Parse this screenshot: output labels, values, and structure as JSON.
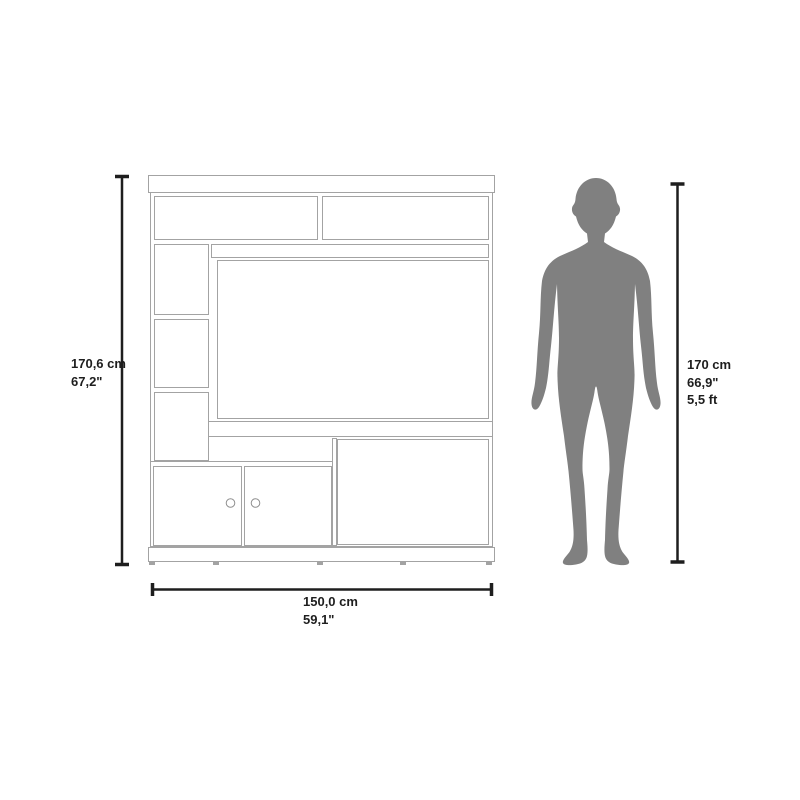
{
  "colors": {
    "background": "#ffffff",
    "furniture_outline": "#a3a3a3",
    "dimension_line": "#1e1e1e",
    "silhouette": "#808080"
  },
  "icons": {
    "silhouette": "standing-person-silhouette",
    "drawing": "entertainment-center-line-drawing"
  },
  "furniture_dimensions": {
    "height": {
      "cm": "170,6 cm",
      "inches": "67,2\""
    },
    "width": {
      "cm": "150,0 cm",
      "inches": "59,1\""
    }
  },
  "person_dimensions": {
    "height": {
      "cm": "170 cm",
      "inches": "66,9\"",
      "feet": "5,5 ft"
    }
  }
}
